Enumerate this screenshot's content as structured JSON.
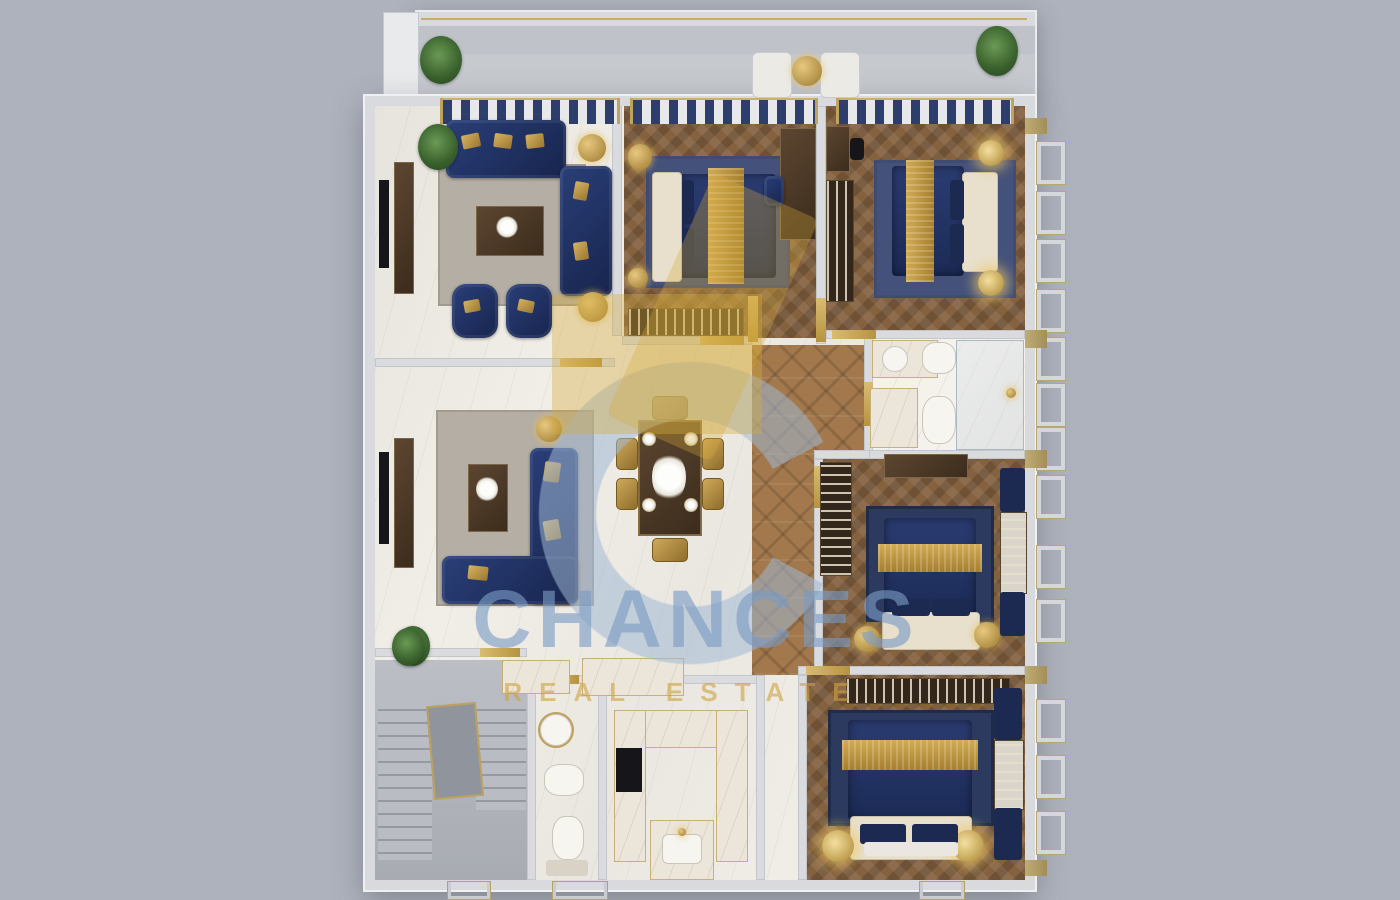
{
  "watermark": {
    "title": "CHANCES",
    "subtitle": "REAL ESTATE"
  },
  "palette": {
    "bg": "#aeb2bc",
    "wall": "#d9dbdf",
    "marble": "#f1eee8",
    "wood": "#84613f",
    "parquet": "#a2784c",
    "navy": "#1f3160",
    "gold": "#bd9c50",
    "cream": "#e8e0cd",
    "rug-gray": "#b5aea4",
    "rug-blue": "#44517a",
    "rug-navy": "#2b3a5e",
    "stone": "#b2b6bd",
    "watermark-blue": "#7a9cc5",
    "watermark-gold": "#cea33e"
  },
  "rooms": [
    "terrace",
    "formal-living-room",
    "bedroom-1",
    "bedroom-2",
    "family-sitting-room",
    "dining-area",
    "hallway",
    "bathroom",
    "bedroom-3",
    "bedroom-4",
    "entry-hall",
    "kitchen",
    "powder-room",
    "staircase"
  ]
}
